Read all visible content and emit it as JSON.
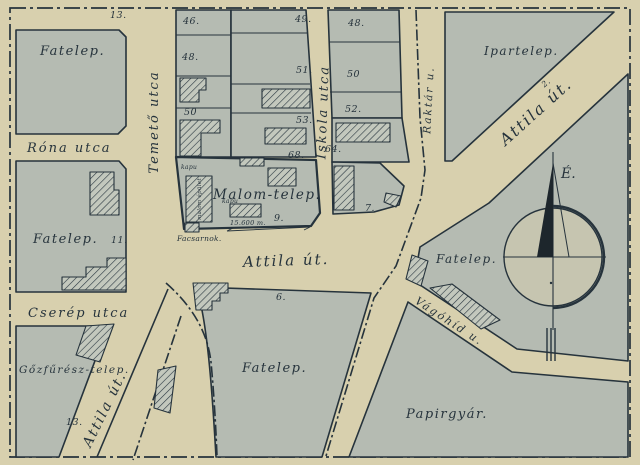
{
  "map": {
    "region_labels": {
      "fatelep_nw": "Fatelep.",
      "fatelep_west": "Fatelep.",
      "fatelep_south": "Fatelep.",
      "fatelep_east": "Fatelep.",
      "ipartelep": "Ipartelep.",
      "malom_telep": "Malom-telep.",
      "gozfuresz_telep": "Gőzfűrész-telep.",
      "papirgyar": "Papirgyár."
    },
    "street_labels": {
      "temeto": "Temető utca",
      "rona": "Róna utca",
      "cserep": "Cserép utca",
      "iskola": "Iskola utca",
      "raktar": "Raktár u.",
      "attila_center": "Attila út.",
      "attila_ne": "Attila út.",
      "attila_sw": "Attila út.",
      "vagohid": "Vágóhíd u."
    },
    "parcel_numbers": {
      "p13_nw": "13.",
      "p46": "46.",
      "p48w": "48.",
      "p50w": "50",
      "p49": "49.",
      "p51": "51.",
      "p53": "53.",
      "p68": "68.",
      "p48e": "48.",
      "p50e": "50",
      "p52": "52.",
      "p64": "64.",
      "p11": "11.",
      "p9": "9.",
      "p7": "7.",
      "p6": "6.",
      "p13_sw": "13.",
      "p2": "2."
    },
    "annotations": {
      "kapu_top": "kapu",
      "kapu_mid": "kapu",
      "dim_bottom": "15.600 m.",
      "legend_label": "Facsarnok.",
      "mill_building": "malom épület",
      "compass_north": "É."
    },
    "colors": {
      "paper": "#d8d0ae",
      "block_fill": "#b5bbb2",
      "ink": "#26333c",
      "hatch": "#2a3740"
    }
  }
}
